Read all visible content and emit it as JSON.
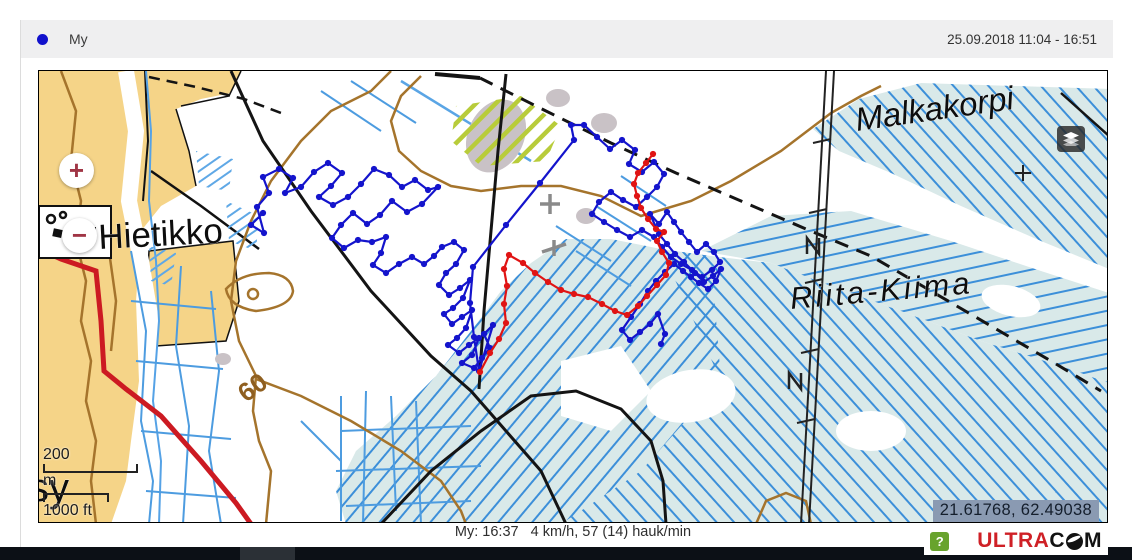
{
  "header": {
    "device_label": "My",
    "legend_dot_color": "#1111cc",
    "date_range": "25.09.2018 11:04 - 16:51"
  },
  "map": {
    "place_names": {
      "hietikko": "Hietikko",
      "malkakorpi": "Malkakorpi",
      "riita_kiima": "Riita-Kiima",
      "partial_name": "sy"
    },
    "contour_label": "60",
    "controls": {
      "zoom_in": "+",
      "zoom_out": "−",
      "layers_icon": "layers"
    },
    "scale": {
      "metric_value": "200",
      "metric_unit": "m",
      "imperial_value": "1000 ft"
    },
    "coordinates": "21.61768, 62.49038"
  },
  "status_bar": {
    "text": "My: 16:37   4 km/h, 57 (14) hauk/min"
  },
  "footer": {
    "help_label": "?",
    "logo_ultra": "ULTRA",
    "logo_c": "C",
    "logo_m": "M"
  },
  "colors": {
    "track_blue": "#1414cc",
    "track_red": "#e01414",
    "field_tan": "#f5d488",
    "bog_fill": "#d9e9e9",
    "ditch_blue": "#4d9ce0",
    "contour_brown": "#a5742c",
    "road_red": "#cc1a22"
  },
  "gps_tracks": {
    "blue": {
      "name": "My",
      "color": "#1414cc",
      "points": [
        [
          262,
          212
        ],
        [
          250,
          224
        ],
        [
          263,
          232
        ],
        [
          256,
          206
        ],
        [
          268,
          192
        ],
        [
          262,
          176
        ],
        [
          278,
          168
        ],
        [
          292,
          177
        ],
        [
          284,
          192
        ],
        [
          300,
          186
        ],
        [
          313,
          171
        ],
        [
          327,
          162
        ],
        [
          341,
          172
        ],
        [
          330,
          185
        ],
        [
          318,
          196
        ],
        [
          332,
          204
        ],
        [
          347,
          196
        ],
        [
          360,
          183
        ],
        [
          373,
          168
        ],
        [
          388,
          174
        ],
        [
          401,
          186
        ],
        [
          414,
          179
        ],
        [
          427,
          189
        ],
        [
          437,
          186
        ],
        [
          421,
          203
        ],
        [
          406,
          211
        ],
        [
          391,
          200
        ],
        [
          379,
          214
        ],
        [
          366,
          223
        ],
        [
          352,
          212
        ],
        [
          340,
          224
        ],
        [
          331,
          237
        ],
        [
          343,
          247
        ],
        [
          357,
          239
        ],
        [
          371,
          241
        ],
        [
          385,
          236
        ],
        [
          380,
          252
        ],
        [
          372,
          264
        ],
        [
          385,
          272
        ],
        [
          398,
          263
        ],
        [
          411,
          256
        ],
        [
          423,
          263
        ],
        [
          433,
          255
        ],
        [
          441,
          246
        ],
        [
          453,
          241
        ],
        [
          463,
          249
        ],
        [
          455,
          263
        ],
        [
          445,
          272
        ],
        [
          438,
          284
        ],
        [
          448,
          294
        ],
        [
          459,
          287
        ],
        [
          469,
          279
        ],
        [
          462,
          297
        ],
        [
          452,
          307
        ],
        [
          443,
          313
        ],
        [
          451,
          323
        ],
        [
          461,
          316
        ],
        [
          471,
          309
        ],
        [
          465,
          327
        ],
        [
          456,
          337
        ],
        [
          447,
          344
        ],
        [
          458,
          352
        ],
        [
          468,
          344
        ],
        [
          478,
          337
        ],
        [
          471,
          354
        ],
        [
          461,
          362
        ],
        [
          473,
          367
        ],
        [
          481,
          357
        ],
        [
          489,
          347
        ],
        [
          483,
          333
        ],
        [
          492,
          324
        ],
        [
          478,
          370
        ],
        [
          473,
          336
        ],
        [
          469,
          302
        ],
        [
          472,
          266
        ],
        [
          505,
          224
        ],
        [
          539,
          182
        ],
        [
          573,
          139
        ],
        [
          570,
          124
        ],
        [
          583,
          124
        ],
        [
          596,
          136
        ],
        [
          609,
          148
        ],
        [
          621,
          139
        ],
        [
          634,
          149
        ],
        [
          628,
          163
        ],
        [
          641,
          171
        ],
        [
          653,
          161
        ],
        [
          663,
          173
        ],
        [
          656,
          186
        ],
        [
          646,
          196
        ],
        [
          635,
          206
        ],
        [
          622,
          199
        ],
        [
          610,
          191
        ],
        [
          598,
          201
        ],
        [
          591,
          213
        ],
        [
          603,
          221
        ],
        [
          616,
          229
        ],
        [
          629,
          236
        ],
        [
          641,
          229
        ],
        [
          653,
          236
        ],
        [
          661,
          246
        ],
        [
          670,
          256
        ],
        [
          680,
          263
        ],
        [
          691,
          269
        ],
        [
          701,
          276
        ],
        [
          711,
          269
        ],
        [
          719,
          261
        ],
        [
          713,
          251
        ],
        [
          705,
          243
        ],
        [
          696,
          251
        ],
        [
          688,
          241
        ],
        [
          680,
          231
        ],
        [
          673,
          221
        ],
        [
          666,
          211
        ],
        [
          658,
          223
        ],
        [
          649,
          213
        ],
        [
          658,
          233
        ],
        [
          666,
          243
        ],
        [
          674,
          253
        ],
        [
          683,
          261
        ],
        [
          694,
          272
        ],
        [
          703,
          281
        ],
        [
          712,
          275
        ],
        [
          720,
          268
        ],
        [
          715,
          280
        ],
        [
          707,
          288
        ],
        [
          698,
          282
        ],
        [
          690,
          276
        ],
        [
          682,
          270
        ],
        [
          673,
          263
        ],
        [
          664,
          271
        ],
        [
          655,
          280
        ],
        [
          647,
          290
        ],
        [
          639,
          303
        ],
        [
          630,
          316
        ],
        [
          621,
          329
        ],
        [
          629,
          339
        ],
        [
          639,
          331
        ],
        [
          649,
          323
        ],
        [
          657,
          313
        ],
        [
          664,
          333
        ],
        [
          660,
          343
        ]
      ]
    },
    "red": {
      "name": "track-2",
      "color": "#e01414",
      "points": [
        [
          479,
          371
        ],
        [
          489,
          352
        ],
        [
          498,
          338
        ],
        [
          505,
          322
        ],
        [
          503,
          303
        ],
        [
          506,
          285
        ],
        [
          503,
          268
        ],
        [
          508,
          254
        ],
        [
          522,
          262
        ],
        [
          534,
          272
        ],
        [
          547,
          281
        ],
        [
          560,
          289
        ],
        [
          573,
          293
        ],
        [
          587,
          296
        ],
        [
          601,
          303
        ],
        [
          614,
          310
        ],
        [
          626,
          314
        ],
        [
          637,
          305
        ],
        [
          646,
          295
        ],
        [
          656,
          284
        ],
        [
          665,
          274
        ],
        [
          668,
          262
        ],
        [
          661,
          251
        ],
        [
          656,
          240
        ],
        [
          663,
          231
        ],
        [
          655,
          228
        ],
        [
          647,
          218
        ],
        [
          640,
          207
        ],
        [
          636,
          195
        ],
        [
          633,
          183
        ],
        [
          637,
          172
        ],
        [
          645,
          162
        ],
        [
          652,
          153
        ]
      ]
    }
  }
}
